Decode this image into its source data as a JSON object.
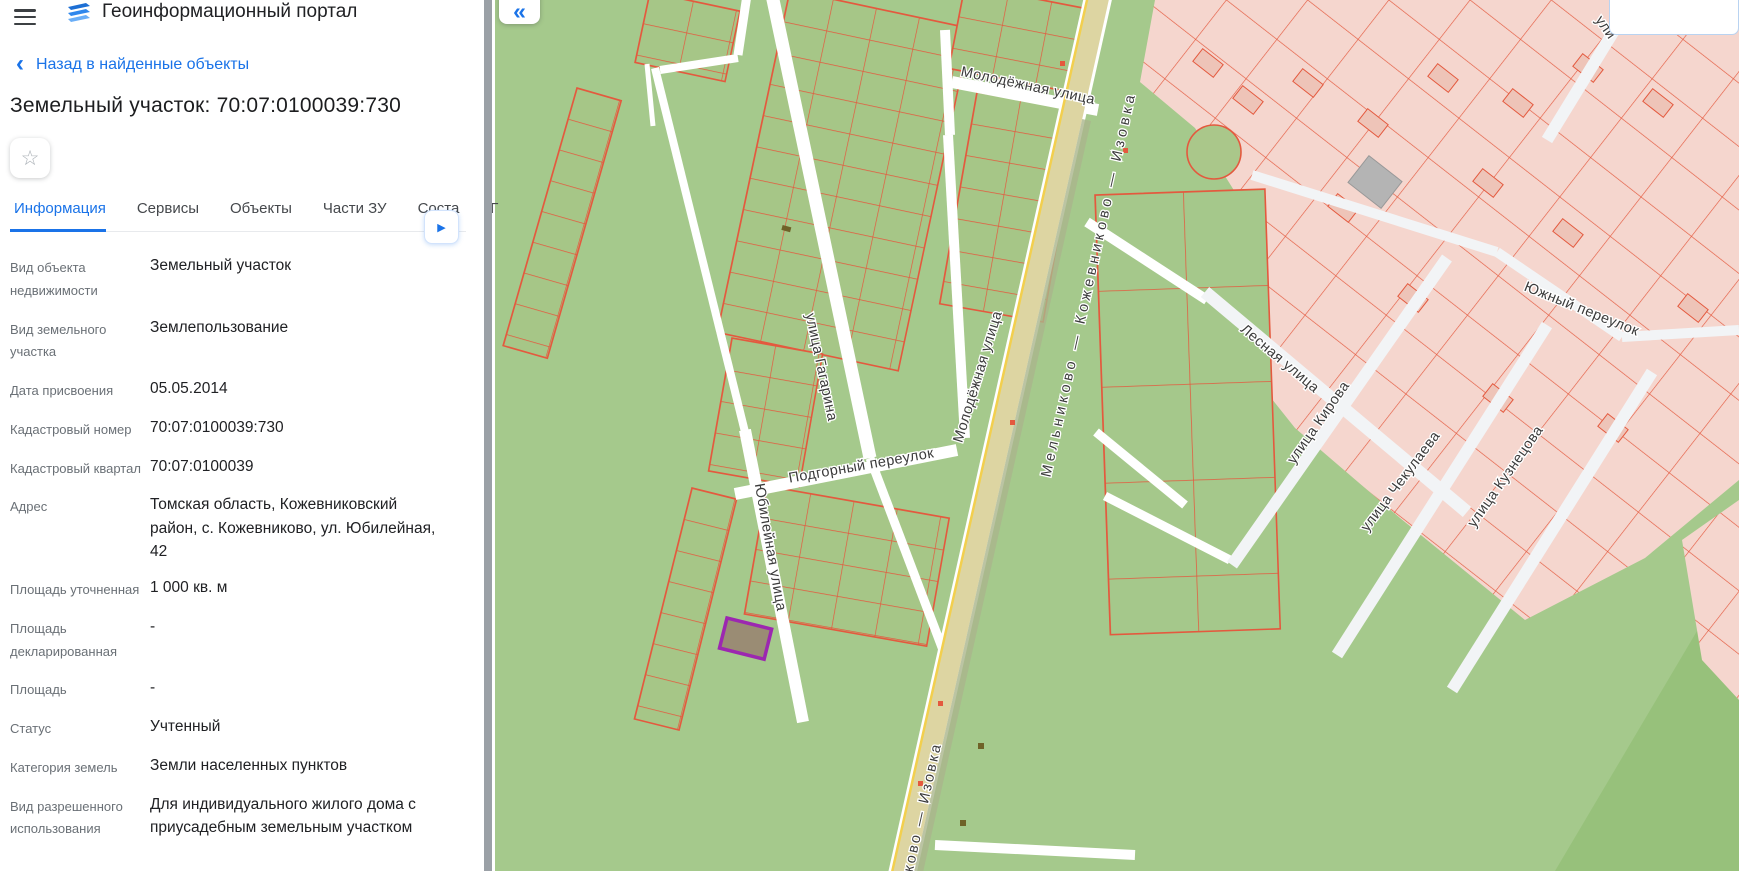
{
  "header": {
    "title": "Геоинформационный портал",
    "menu_icon": "hamburger"
  },
  "back": {
    "chevron": "‹",
    "label": "Назад в найденные объекты"
  },
  "page_title": "Земельный участок: 70:07:0100039:730",
  "favorite": {
    "star_icon": "☆"
  },
  "tabs": {
    "items": [
      {
        "label": "Информация",
        "active": true
      },
      {
        "label": "Сервисы",
        "active": false
      },
      {
        "label": "Объекты",
        "active": false
      },
      {
        "label": "Части ЗУ",
        "active": false
      },
      {
        "label": "Соста",
        "active": false
      },
      {
        "label": "Г",
        "active": false
      }
    ],
    "next_arrow_icon": "▶"
  },
  "info": {
    "rows": [
      {
        "label": "Вид объекта недвижимости",
        "value": "Земельный участок"
      },
      {
        "label": "Вид земельного участка",
        "value": "Землепользование"
      },
      {
        "label": "Дата присвоения",
        "value": "05.05.2014"
      },
      {
        "label": "Кадастровый номер",
        "value": "70:07:0100039:730"
      },
      {
        "label": "Кадастровый квартал",
        "value": "70:07:0100039"
      },
      {
        "label": "Адрес",
        "value": "Томская область, Кожевниковский район, с. Кожевниково, ул. Юбилейная, 42"
      },
      {
        "label": "Площадь уточненная",
        "value": "1 000 кв. м"
      },
      {
        "label": "Площадь декларированная",
        "value": "-"
      },
      {
        "label": "Площадь",
        "value": "-"
      },
      {
        "label": "Статус",
        "value": "Учтенный"
      },
      {
        "label": "Категория земель",
        "value": "Земли населенных пунктов"
      },
      {
        "label": "Вид разрешенного использования",
        "value": "Для индивидуального жилого дома с приусадебным земельным участком"
      }
    ]
  },
  "map": {
    "collapse_icon": "«",
    "labels": [
      {
        "text": "Молодёжная улица"
      },
      {
        "text": "Мельниково — Кожевниково — Изовка"
      },
      {
        "text": "улица Гагарина"
      },
      {
        "text": "Молодёжная улица"
      },
      {
        "text": "Подгорный переулок"
      },
      {
        "text": "Юбилейная улица"
      },
      {
        "text": "Лесная улица"
      },
      {
        "text": "улица Кирова"
      },
      {
        "text": "улица Чекулаева"
      },
      {
        "text": "улица Кузнецова"
      },
      {
        "text": "Южный переулок"
      },
      {
        "text": "ули"
      },
      {
        "text": "ково — Изовка"
      }
    ],
    "colors": {
      "accent_blue": "#1a73e8",
      "map_green": "#a5c98c",
      "parcel_outline": "#e4593e",
      "pink_area": "#f5d6ce",
      "road_fill": "#ddd5a2",
      "road_yellow_line": "#f2cf4e",
      "selected_parcel_stroke": "#9c27b0",
      "selected_parcel_fill": "#9a8c74"
    }
  }
}
